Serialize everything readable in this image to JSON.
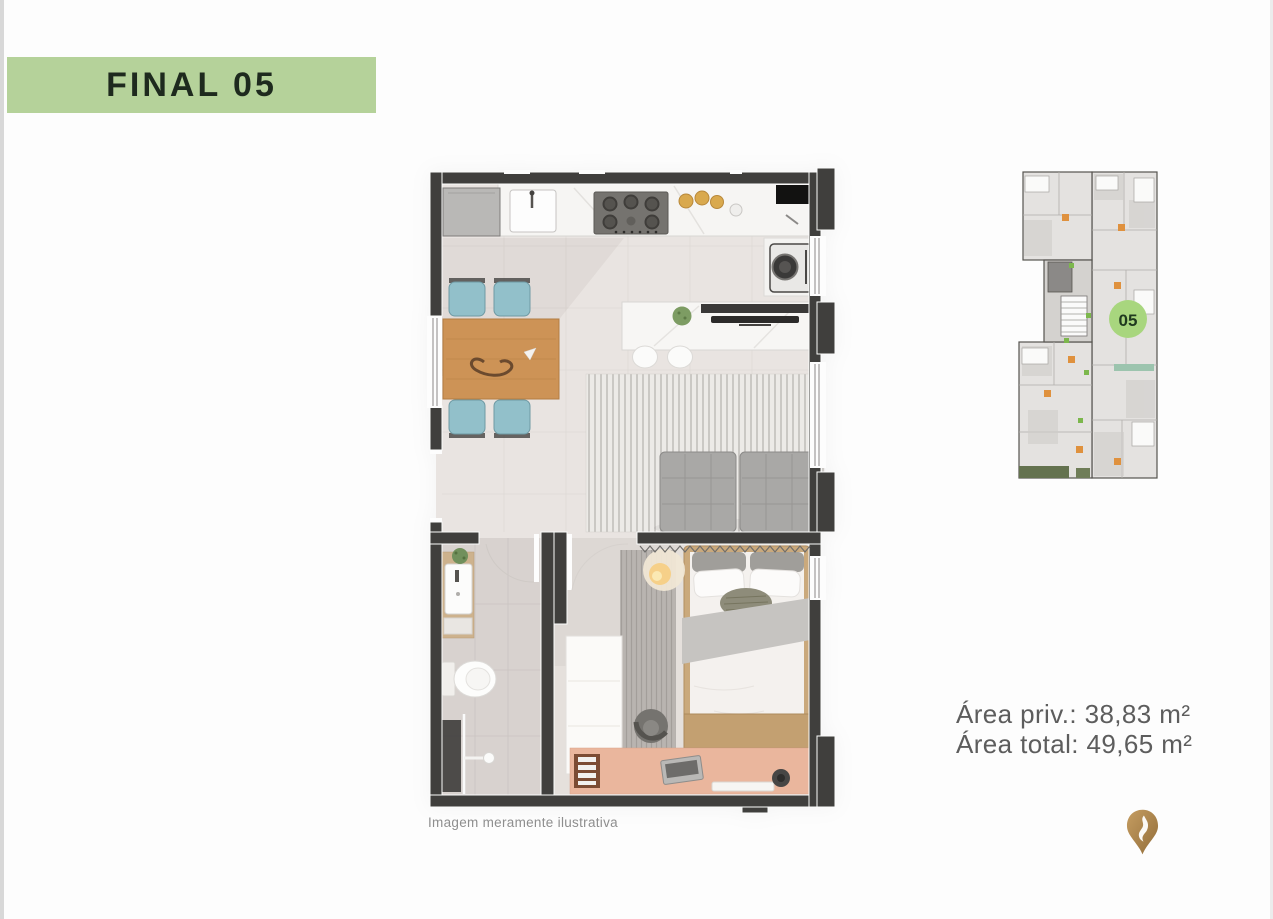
{
  "page": {
    "left_edge_color": "#d8d8d8",
    "right_edge_color": "#ececec",
    "background": "#fdfdfd"
  },
  "header": {
    "title": "FINAL 05",
    "banner_color": "#b5d29a",
    "text_color": "#1e2a1e"
  },
  "floor_plan": {
    "caption": "Imagem meramente ilustrativa",
    "wall_color": "#403f3d",
    "accent_colors": {
      "dining_table_wood": "#cd9356",
      "chair_blue": "#92c0ca",
      "sofa_gray": "#a9a8a6",
      "bed_wood": "#caa97c",
      "desk_salmon": "#eab69d"
    }
  },
  "key_plan": {
    "unit_badge": "05",
    "badge_color": "#a8d67e",
    "badge_text_color": "#1f3a1f"
  },
  "areas": {
    "private": "Área priv.: 38,83 m²",
    "total": "Área total: 49,65 m²",
    "text_color": "#5d5d5d"
  },
  "logo": {
    "icon": "gold-location-pin",
    "gold_start": "#c59d61",
    "gold_end": "#926d3a"
  }
}
